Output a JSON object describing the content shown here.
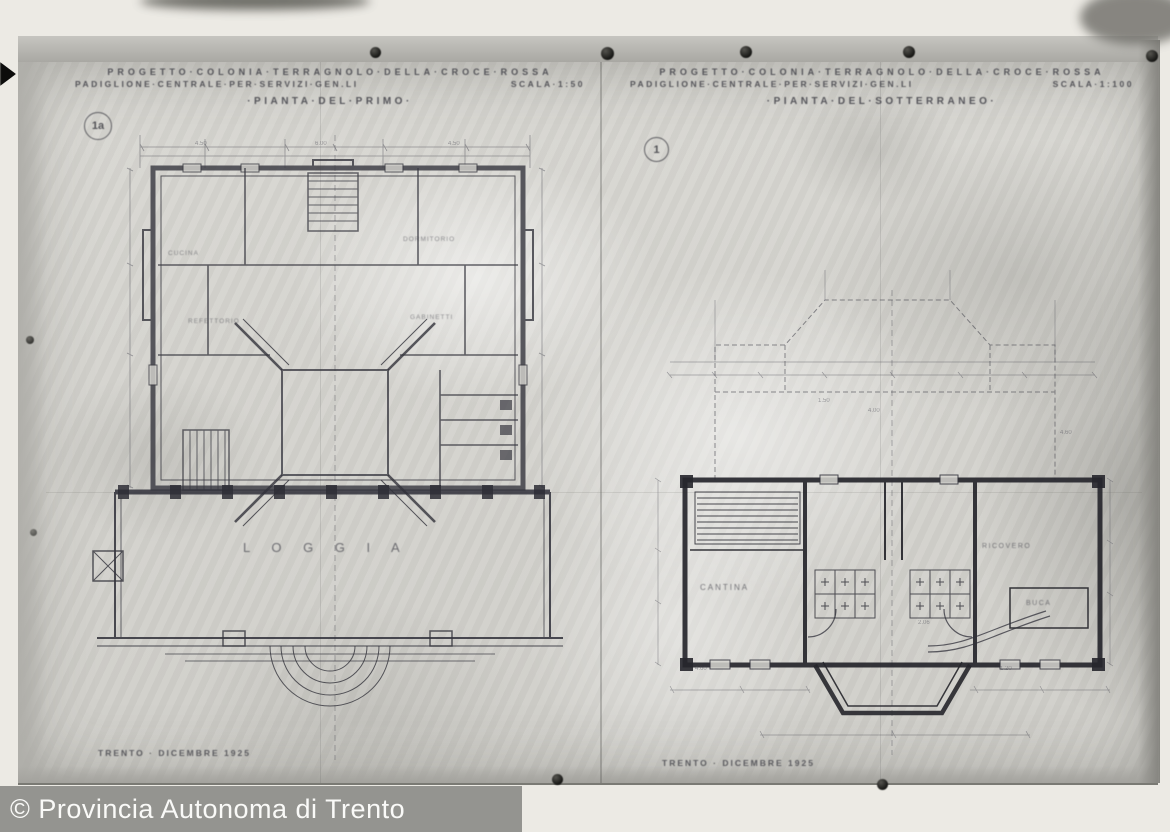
{
  "watermark": {
    "text": "© Provincia Autonoma di Trento"
  },
  "sheets": {
    "left": {
      "ref": "1a",
      "title1": "PROGETTO·COLONIA·TERRAGNOLO·DELLA·CROCE·ROSSA",
      "title2a": "PADIGLIONE·CENTRALE·PER·SERVIZI·GEN.LI",
      "title2b": "SCALA·1:50",
      "subtitle": "·PIANTA·DEL·PRIMO·",
      "loggia": "L O G G I A",
      "date": "TRENTO · DICEMBRE 1925",
      "rooms": {
        "r1": "CUCINA",
        "r2": "REFETTORIO",
        "r3": "DORMITORIO",
        "r4": "GABINETTI"
      },
      "dims": [
        "4.50",
        "6.00",
        "4.50"
      ]
    },
    "right": {
      "ref": "1",
      "title1": "PROGETTO·COLONIA·TERRAGNOLO·DELLA·CROCE·ROSSA",
      "title2a": "PADIGLIONE·CENTRALE·PER·SERVIZI·GEN.LI",
      "title2b": "SCALA·1:100",
      "subtitle": "·PIANTA·DEL·SOTTERRANEO·",
      "date": "TRENTO · DICEMBRE 1925",
      "rooms": {
        "cantina": "CANTINA",
        "ricovero": "RICOVERO",
        "buca": "BUCA"
      },
      "dims": [
        "4.60",
        "1.50",
        "4.00",
        "2.06",
        "1.20",
        "4.60"
      ]
    }
  },
  "colors": {
    "paper": "#d6d5d0",
    "ink": "#33333a",
    "watermark_bar": "#8e8e8a",
    "watermark_text": "#fafaf8"
  }
}
